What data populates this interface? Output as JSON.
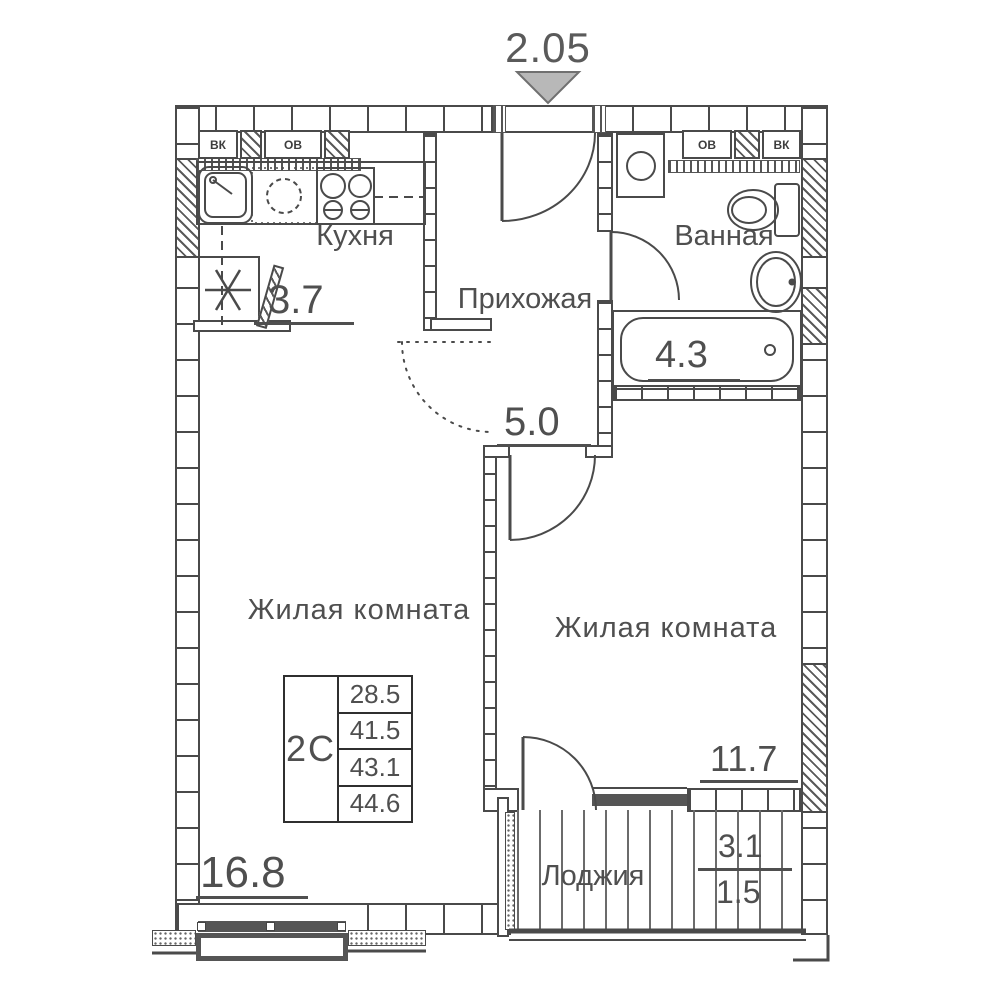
{
  "top_dimension": "2.05",
  "rooms": {
    "kitchen": {
      "label": "Кухня",
      "area": "3.7"
    },
    "hallway": {
      "label": "Прихожая",
      "area": "5.0"
    },
    "bathroom": {
      "label": "Ванная",
      "area": "4.3"
    },
    "living_room_1": {
      "label": "Жилая комната",
      "area": "16.8"
    },
    "living_room_2": {
      "label": "Жилая комната",
      "area": "11.7"
    },
    "loggia": {
      "label": "Лоджия",
      "area_full": "3.1",
      "area_reduced": "1.5"
    }
  },
  "info_table": {
    "apartment_type": "2С",
    "values": [
      "28.5",
      "41.5",
      "43.1",
      "44.6"
    ]
  },
  "shafts": {
    "left": [
      "ВК",
      "ОВ"
    ],
    "right": [
      "ОВ",
      "ВК"
    ]
  },
  "colors": {
    "line": "#4a4a4a",
    "arrow_fill": "#b8b8b8"
  }
}
